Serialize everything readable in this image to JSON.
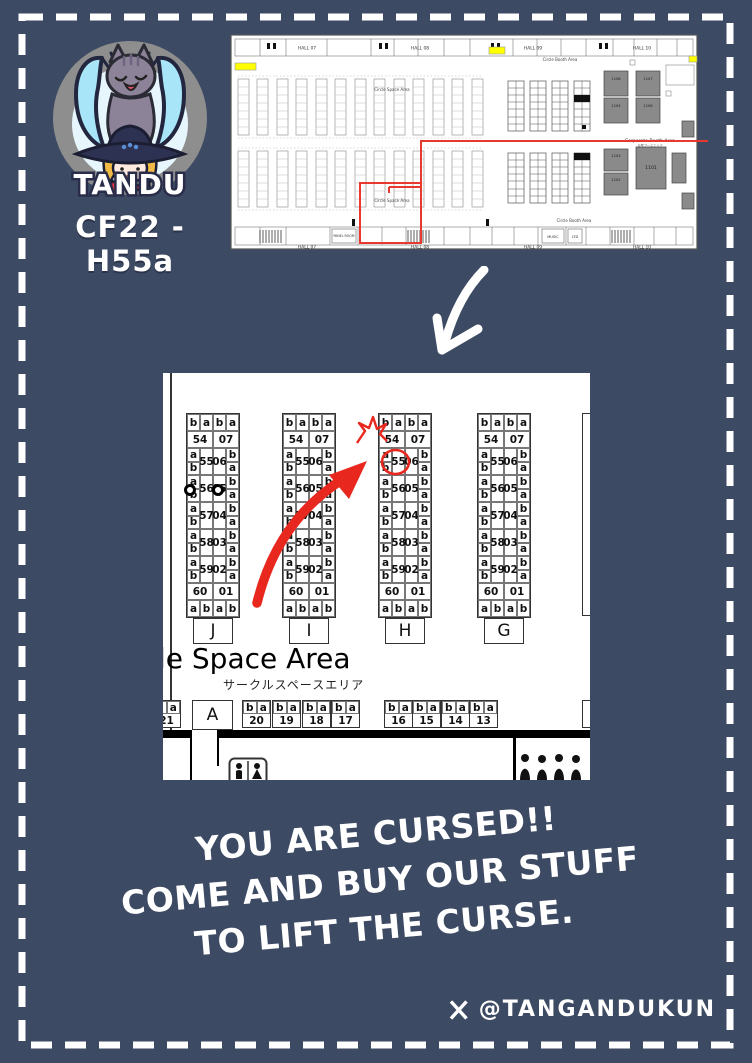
{
  "colors": {
    "background": "#3d4a63",
    "annotation_red": "#e8281e",
    "highlight_yellow": "#ffff00"
  },
  "header": {
    "logo_text": "TANDU",
    "booth_code": "CF22 - H55a"
  },
  "overview_map": {
    "halls_top": [
      "HALL 07",
      "HALL 08",
      "HALL 09",
      "HALL 10"
    ],
    "halls_bottom": [
      "HALL 07",
      "HALL 08",
      "HALL 09",
      "HALL 10"
    ],
    "labels": {
      "circle_space": "Circle Space Area",
      "circle_booth": "Circle Booth Area",
      "corporate": "Corporate Booth Area",
      "corporate_jp": "企業ブースエリア",
      "panel_room": "PANEL ROOM",
      "music": "MUSIC",
      "ltd": "LTD"
    },
    "corp_numbers": [
      "1108",
      "1104",
      "1107",
      "1106",
      "1103",
      "1102",
      "1101"
    ]
  },
  "zoom_map": {
    "col_labels": [
      "J",
      "I",
      "H",
      "G"
    ],
    "edge_cells_top": [
      "b",
      "a",
      "b",
      "a"
    ],
    "edge_cells_bottom": [
      "a",
      "b",
      "a",
      "b"
    ],
    "pair_top": [
      "54",
      "07"
    ],
    "pair_bottom": [
      "60",
      "01"
    ],
    "left_stack": [
      "a",
      "b"
    ],
    "right_stack": [
      "b",
      "a"
    ],
    "mid_pairs": [
      [
        "55",
        "06"
      ],
      [
        "56",
        "05"
      ],
      [
        "57",
        "04"
      ],
      [
        "58",
        "03"
      ],
      [
        "59",
        "02"
      ]
    ],
    "highlight": {
      "column": "H",
      "booth": "55"
    },
    "pillar_marks": {
      "column": "J",
      "booth": "56"
    },
    "area_label": "le Space Area",
    "area_label_jp": "サークルスペースエリア",
    "entrance_label": "A",
    "bottom_partial": {
      "cells": [
        "b",
        "a"
      ],
      "num": "21"
    },
    "bottom_groups": [
      {
        "cells": [
          "b",
          "a"
        ],
        "num": "20"
      },
      {
        "cells": [
          "b",
          "a"
        ],
        "num": "19"
      },
      {
        "cells": [
          "b",
          "a"
        ],
        "num": "18"
      },
      {
        "cells": [
          "b",
          "a"
        ],
        "num": "17"
      },
      {
        "cells": [
          "b",
          "a"
        ],
        "num": "16"
      },
      {
        "cells": [
          "b",
          "a"
        ],
        "num": "15"
      },
      {
        "cells": [
          "b",
          "a"
        ],
        "num": "14"
      },
      {
        "cells": [
          "b",
          "a"
        ],
        "num": "13"
      }
    ]
  },
  "caption": {
    "lines": [
      "YOU ARE CURSED!!",
      "COME AND BUY OUR STUFF",
      "TO LIFT THE CURSE."
    ]
  },
  "footer": {
    "network": "X",
    "handle": "@TANGANDUKUN"
  },
  "icons": {
    "down_arrow": "hand-drawn-down-arrow",
    "toilet": "restroom-icon",
    "crowd": "people-silhouettes-icon",
    "x_logo": "x-logo-icon",
    "starburst": "impact-spark",
    "pillar": "pillar-marker"
  }
}
